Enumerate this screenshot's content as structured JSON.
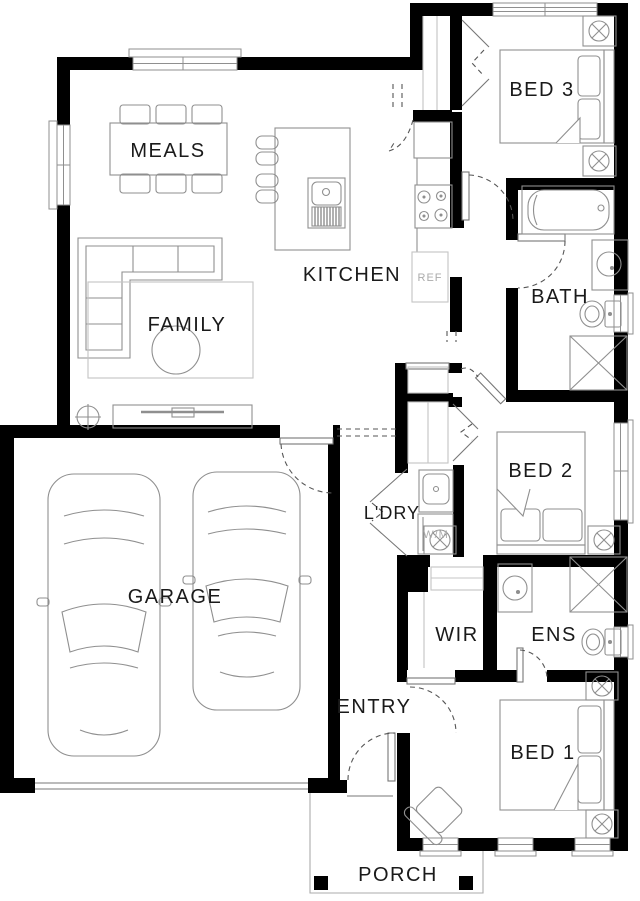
{
  "rooms": {
    "meals": "MEALS",
    "kitchen": "KITCHEN",
    "family": "FAMILY",
    "garage": "GARAGE",
    "entry": "ENTRY",
    "porch": "PORCH",
    "bed3": "BED 3",
    "bath": "BATH",
    "bed2": "BED 2",
    "laundry": "L'DRY",
    "wir": "WIR",
    "ens": "ENS",
    "bed1": "BED 1"
  },
  "appliances": {
    "fridge": "REF",
    "washer": "W/M"
  },
  "colors": {
    "wall": "#000000",
    "furniture": "#8f8f8f",
    "fixture": "#777777",
    "swing": "#555555",
    "label": "#1a1a1a",
    "muted": "#ababab",
    "faint": "#c4c4c4"
  }
}
